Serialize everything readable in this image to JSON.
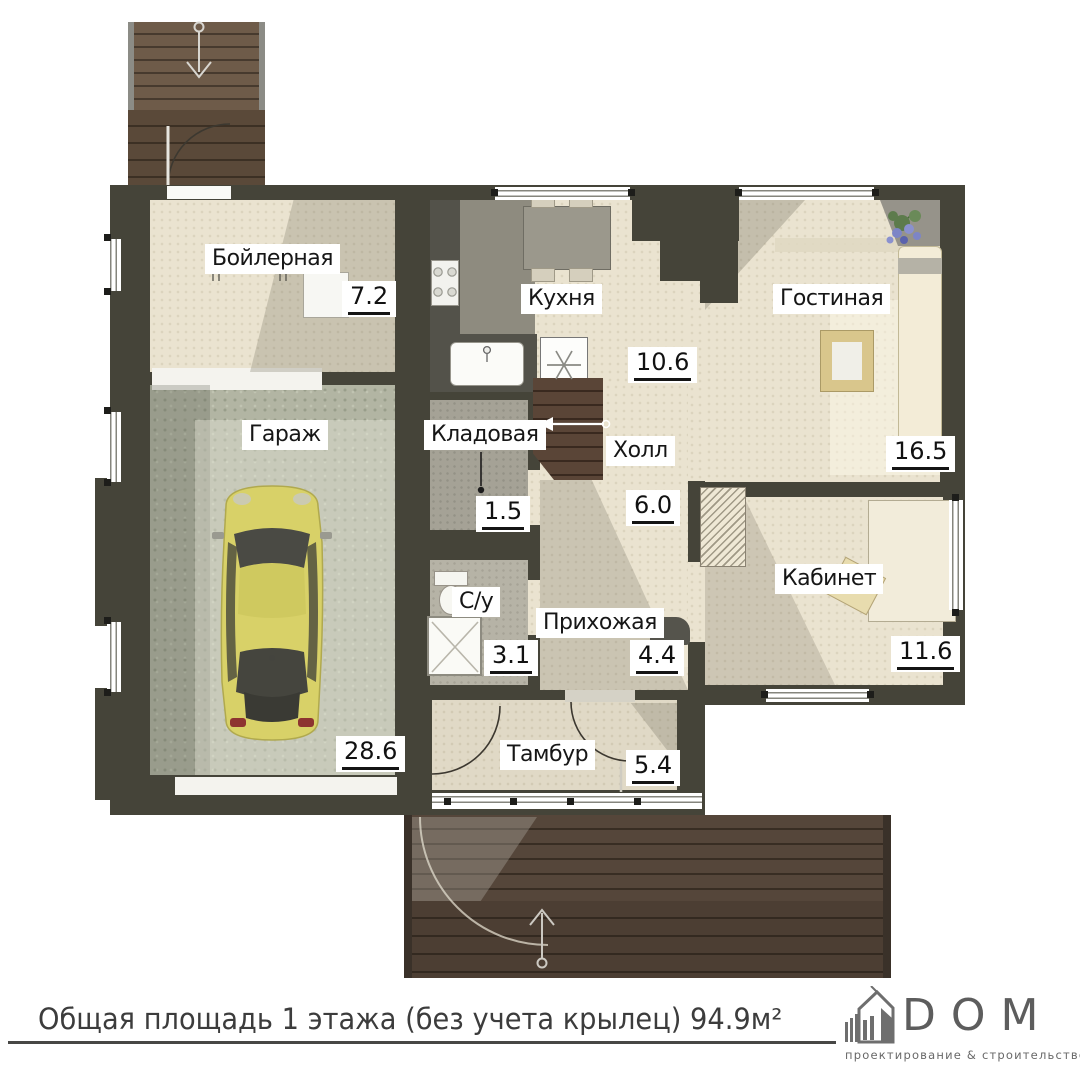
{
  "rooms": [
    {
      "label": "Бойлерная",
      "area": "7.2"
    },
    {
      "label": "Кухня",
      "area": "10.6"
    },
    {
      "label": "Гостиная",
      "area": "16.5"
    },
    {
      "label": "Гараж",
      "area": "28.6"
    },
    {
      "label": "Кладовая",
      "area": "1.5"
    },
    {
      "label": "Холл",
      "area": "6.0"
    },
    {
      "label": "С/у",
      "area": "3.1"
    },
    {
      "label": "Прихожая",
      "area": "4.4"
    },
    {
      "label": "Кабинет",
      "area": "11.6"
    },
    {
      "label": "Тамбур",
      "area": "5.4"
    }
  ],
  "footer": {
    "caption": "Общая площадь 1 этажа (без учета крылец) 94.9м²",
    "logo_name": "DOM",
    "logo_tagline": "проектирование & строительство"
  },
  "colors": {
    "wall": "#454439",
    "floor_beige": "#eae3d0",
    "floor_garage": "#b2b5a3",
    "wood_dark": "#54453a",
    "car": "#d8d168",
    "logo_gray": "#5d5d5d"
  }
}
